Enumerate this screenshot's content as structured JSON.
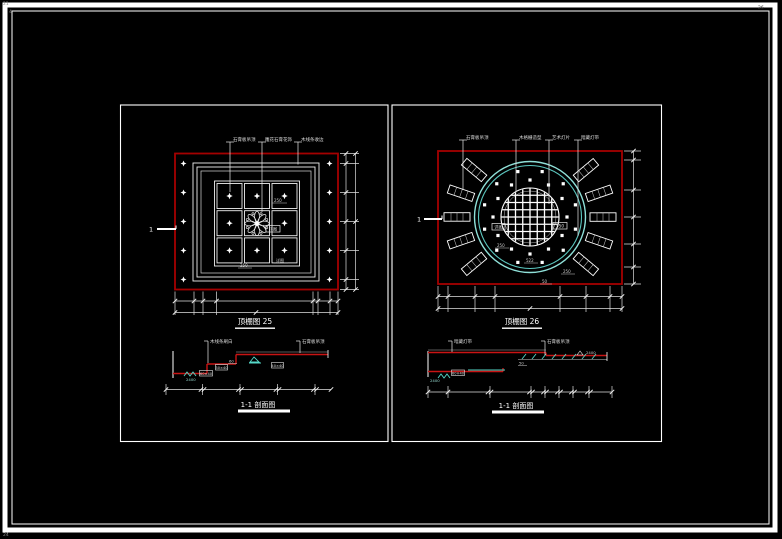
{
  "page": {
    "corner_top_left_1": "21",
    "corner_top_left_2": "4",
    "corner_bottom_left": "24",
    "corner_top_right": "26"
  },
  "left_drawing": {
    "title": "顶棚图 25",
    "leader_labels": [
      "石膏板吊顶",
      "雕花石膏花饰",
      "木线条收边"
    ],
    "section_marker": "1",
    "detail_note": "详图",
    "note_top": "250",
    "note_bottom_left": "250",
    "note_bottom_right": "详图"
  },
  "right_drawing": {
    "title": "顶棚图 26",
    "leader_labels": [
      "石膏板吊顶",
      "木格栅造型",
      "艺术灯片",
      "暗藏灯带"
    ],
    "section_marker": "1",
    "boxed_note_left": "详图",
    "boxed_note_right": "550",
    "note_a": "250",
    "note_b": "522",
    "note_c": "250",
    "note_d": "50"
  },
  "section_a": {
    "title": "1-1 剖面图",
    "labels": [
      "木线条刷白",
      "石膏板吊顶"
    ],
    "boxed_notes": [
      "60×40",
      "30×40",
      "40×40"
    ],
    "note_mid": "60",
    "note_level": "2400"
  },
  "section_b": {
    "title": "1-1 剖面图",
    "labels": [
      "暗藏灯带",
      "石膏板吊顶"
    ],
    "boxed_note": "60×40",
    "note_level_left": "2400",
    "note_level_right": "2400",
    "note_mid": "50"
  },
  "colors": {
    "red": "#a40000",
    "red_bright": "#c81414",
    "cyan": "#55d8c8",
    "cyan_pale": "#8fe0d8",
    "line": "#e8e8e8"
  }
}
